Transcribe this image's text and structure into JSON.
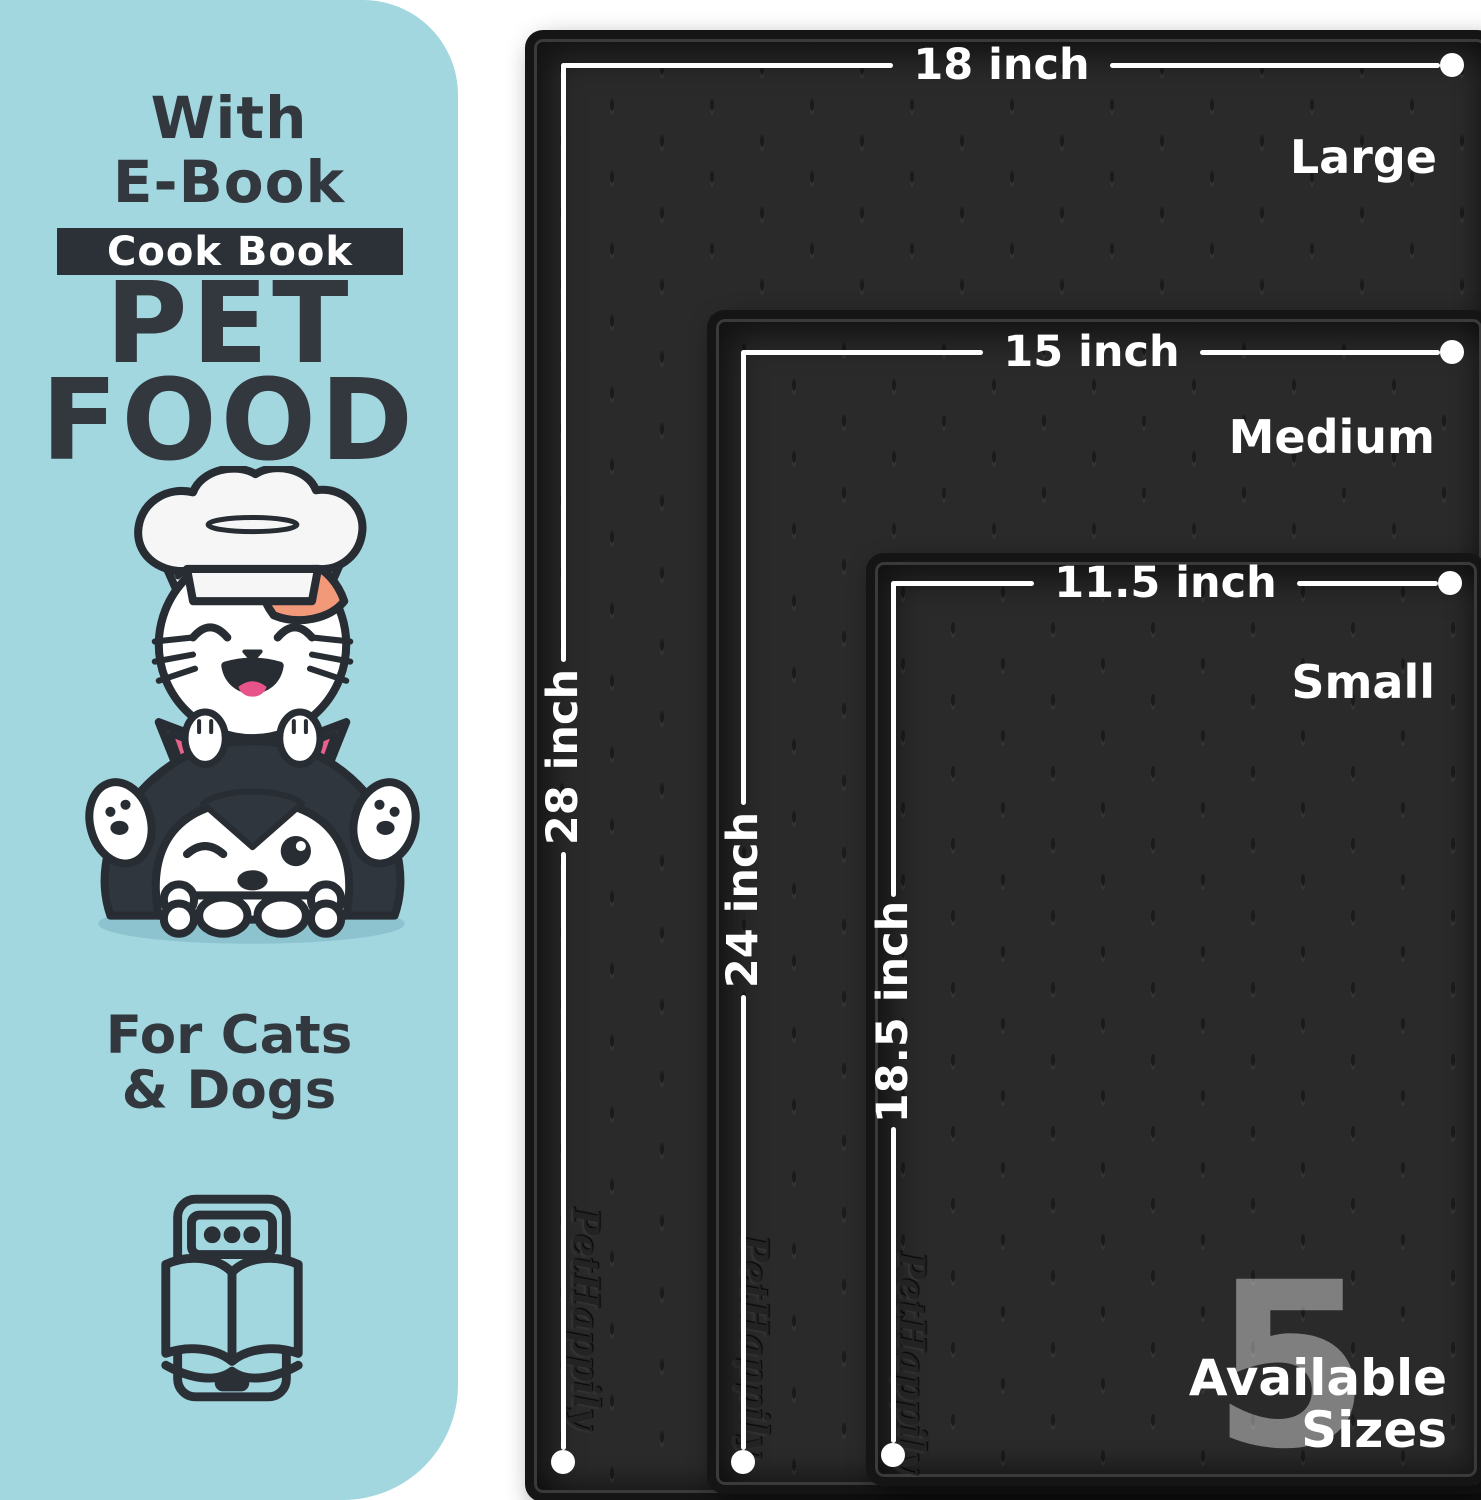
{
  "panel": {
    "heading_line1": "With",
    "heading_line2": "E-Book",
    "badge_label": "Cook Book",
    "title_line1": "PET",
    "title_line2": "FOOD",
    "audience_line1": "For Cats",
    "audience_line2": "& Dogs"
  },
  "mats": [
    {
      "name": "Large",
      "width_label": "18 inch",
      "length_label": "28 inch",
      "brand_emboss": "PetHappily"
    },
    {
      "name": "Medium",
      "width_label": "15 inch",
      "length_label": "24 inch",
      "brand_emboss": "PetHappily"
    },
    {
      "name": "Small",
      "width_label": "11.5 inch",
      "length_label": "18.5 inch",
      "brand_emboss": "PetHappily"
    }
  ],
  "sizes_badge": {
    "count": "5",
    "line1": "Available",
    "line2": "Sizes"
  },
  "colors": {
    "panel_bg": "#a3d7e0",
    "ink": "#32383e",
    "badge_bg": "#2b3137",
    "mat_surface": "#2a2a2a",
    "mat_border": "#151515",
    "measure_white": "#ffffff",
    "patch_orange": "#f2997a",
    "ear_pink": "#e8618c"
  }
}
